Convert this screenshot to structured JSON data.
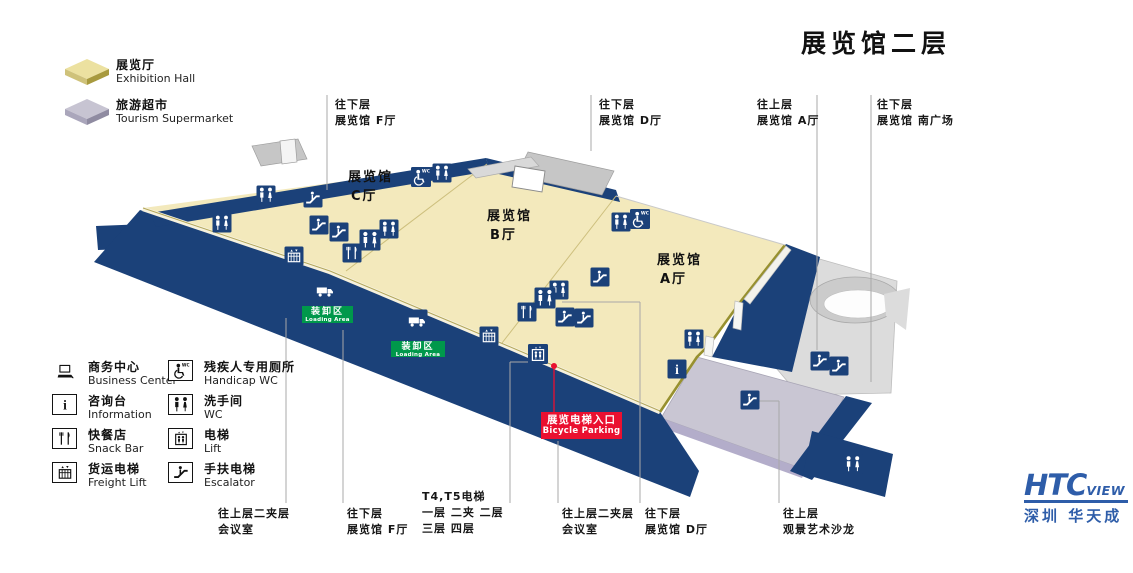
{
  "title": "展览馆二层",
  "colors": {
    "navy": "#1b4179",
    "floor_yellow": "#f3e9bc",
    "supermarket_gray": "#c9c6d3",
    "salon_gray": "#dcdcdc",
    "loading_green": "#00984b",
    "entrance_red": "#ea1030",
    "logo_blue": "#2e5da9"
  },
  "legend_area": {
    "items": [
      {
        "key": "exhibition-hall",
        "zh": "展览厅",
        "en": "Exhibition Hall",
        "top": "#ece1a0",
        "left_side": "#cfc27a",
        "right_side": "#a89a3e",
        "y": 56
      },
      {
        "key": "tourism-supermarket",
        "zh": "旅游超市",
        "en": "Tourism Supermarket",
        "top": "#c7c4d2",
        "left_side": "#aaa6bb",
        "right_side": "#8f8ba1",
        "y": 96
      }
    ]
  },
  "legend_facilities": {
    "items": [
      {
        "icon": "business-center",
        "zh": "商务中心",
        "en": "Business Center"
      },
      {
        "icon": "information",
        "zh": "咨询台",
        "en": "Information"
      },
      {
        "icon": "snack-bar",
        "zh": "快餐店",
        "en": "Snack Bar"
      },
      {
        "icon": "freight-lift",
        "zh": "货运电梯",
        "en": "Freight Lift"
      },
      {
        "icon": "handicap-wc",
        "zh": "残疾人专用厕所",
        "en": "Handicap WC"
      },
      {
        "icon": "wc",
        "zh": "洗手间",
        "en": "WC"
      },
      {
        "icon": "lift",
        "zh": "电梯",
        "en": "Lift"
      },
      {
        "icon": "escalator",
        "zh": "手扶电梯",
        "en": "Escalator"
      }
    ]
  },
  "halls": [
    {
      "name": "展览馆",
      "hall": "C厅",
      "x": 348,
      "y": 168
    },
    {
      "name": "展览馆",
      "hall": "B厅",
      "x": 487,
      "y": 207
    },
    {
      "name": "展览馆",
      "hall": "A厅",
      "x": 657,
      "y": 251
    }
  ],
  "callouts_top": [
    {
      "lines": [
        "往下层",
        "展览馆 F厅"
      ],
      "text_x": 335,
      "text_y": 97,
      "line_x": 327,
      "line_y1": 95,
      "line_y2": 190
    },
    {
      "lines": [
        "往下层",
        "展览馆 D厅"
      ],
      "text_x": 599,
      "text_y": 97,
      "line_x": 591,
      "line_y1": 95,
      "line_y2": 151
    },
    {
      "lines": [
        "往上层",
        "展览馆 A厅"
      ],
      "text_x": 757,
      "text_y": 97,
      "line_x": 817,
      "line_y1": 95,
      "line_y2": 350
    },
    {
      "lines": [
        "往下层",
        "展览馆 南广场"
      ],
      "text_x": 877,
      "text_y": 97,
      "line_x": 871,
      "line_y1": 95,
      "line_y2": 382
    }
  ],
  "callouts_bottom": [
    {
      "lines": [
        "往上层二夹层",
        "会议室"
      ],
      "text_x": 218,
      "text_y": 506,
      "line_x": 286,
      "line_y1": 318,
      "line_y2": 503
    },
    {
      "lines": [
        "往下层",
        "展览馆 F厅"
      ],
      "text_x": 347,
      "text_y": 506,
      "line_x": 343,
      "line_y1": 330,
      "line_y2": 503
    },
    {
      "lines": [
        "T4,T5电梯",
        "一层  二夹  二层",
        "三层  四层"
      ],
      "text_x": 422,
      "text_y": 489,
      "line_x": 510,
      "line_y1": 362,
      "line_y2": 503
    },
    {
      "lines": [
        "往上层二夹层",
        "会议室"
      ],
      "text_x": 562,
      "text_y": 506,
      "line_x": 558,
      "line_y1": 441,
      "line_y2": 503
    },
    {
      "lines": [
        "往下层",
        "展览馆 D厅"
      ],
      "text_x": 645,
      "text_y": 506,
      "line_x": 640,
      "line_y1": 302,
      "line_y2": 503
    },
    {
      "lines": [
        "往上层",
        "观景艺术沙龙"
      ],
      "text_x": 783,
      "text_y": 506,
      "line_x": 779,
      "line_y1": 401,
      "line_y2": 503
    }
  ],
  "loading_areas": [
    {
      "zh": "装卸区",
      "en": "Loading Area",
      "x": 302,
      "y": 306,
      "w": 51,
      "h": 17
    },
    {
      "zh": "装卸区",
      "en": "Loading Area",
      "x": 391,
      "y": 341,
      "w": 54,
      "h": 16
    }
  ],
  "entrance_label": {
    "zh": "展览电梯入口",
    "en": "Bicycle Parking",
    "dot_x": 554,
    "dot_y": 366,
    "line_y2": 412
  },
  "map_icons": [
    {
      "t": "wc",
      "x": 222,
      "y": 223
    },
    {
      "t": "wc",
      "x": 266,
      "y": 195
    },
    {
      "t": "escalator",
      "x": 313,
      "y": 198
    },
    {
      "t": "escalator",
      "x": 319,
      "y": 225
    },
    {
      "t": "escalator",
      "x": 339,
      "y": 232
    },
    {
      "t": "freight-lift",
      "x": 294,
      "y": 256
    },
    {
      "t": "snack-bar",
      "x": 352,
      "y": 253
    },
    {
      "t": "wc",
      "x": 370,
      "y": 240,
      "s": 21
    },
    {
      "t": "wc",
      "x": 389,
      "y": 229
    },
    {
      "t": "handicap-wc",
      "x": 421,
      "y": 177,
      "s": 20
    },
    {
      "t": "wc",
      "x": 442,
      "y": 173
    },
    {
      "t": "truck",
      "x": 325,
      "y": 290,
      "s": 21
    },
    {
      "t": "truck",
      "x": 417,
      "y": 320,
      "s": 21
    },
    {
      "t": "wc",
      "x": 621,
      "y": 222
    },
    {
      "t": "handicap-wc",
      "x": 640,
      "y": 219,
      "s": 20
    },
    {
      "t": "escalator",
      "x": 600,
      "y": 277
    },
    {
      "t": "wc",
      "x": 559,
      "y": 290
    },
    {
      "t": "wc",
      "x": 545,
      "y": 298,
      "s": 21
    },
    {
      "t": "snack-bar",
      "x": 527,
      "y": 312
    },
    {
      "t": "escalator",
      "x": 565,
      "y": 317
    },
    {
      "t": "escalator",
      "x": 584,
      "y": 318
    },
    {
      "t": "freight-lift",
      "x": 489,
      "y": 336
    },
    {
      "t": "lift",
      "x": 538,
      "y": 354,
      "s": 20
    },
    {
      "t": "wc",
      "x": 694,
      "y": 339
    },
    {
      "t": "information",
      "x": 677,
      "y": 369
    },
    {
      "t": "escalator",
      "x": 750,
      "y": 400
    },
    {
      "t": "escalator",
      "x": 820,
      "y": 361
    },
    {
      "t": "escalator",
      "x": 839,
      "y": 366
    },
    {
      "t": "wc",
      "x": 853,
      "y": 464,
      "s": 20
    }
  ],
  "logo": {
    "htc": "HTC",
    "view": "VIEW",
    "zh": "深圳  华天成"
  }
}
